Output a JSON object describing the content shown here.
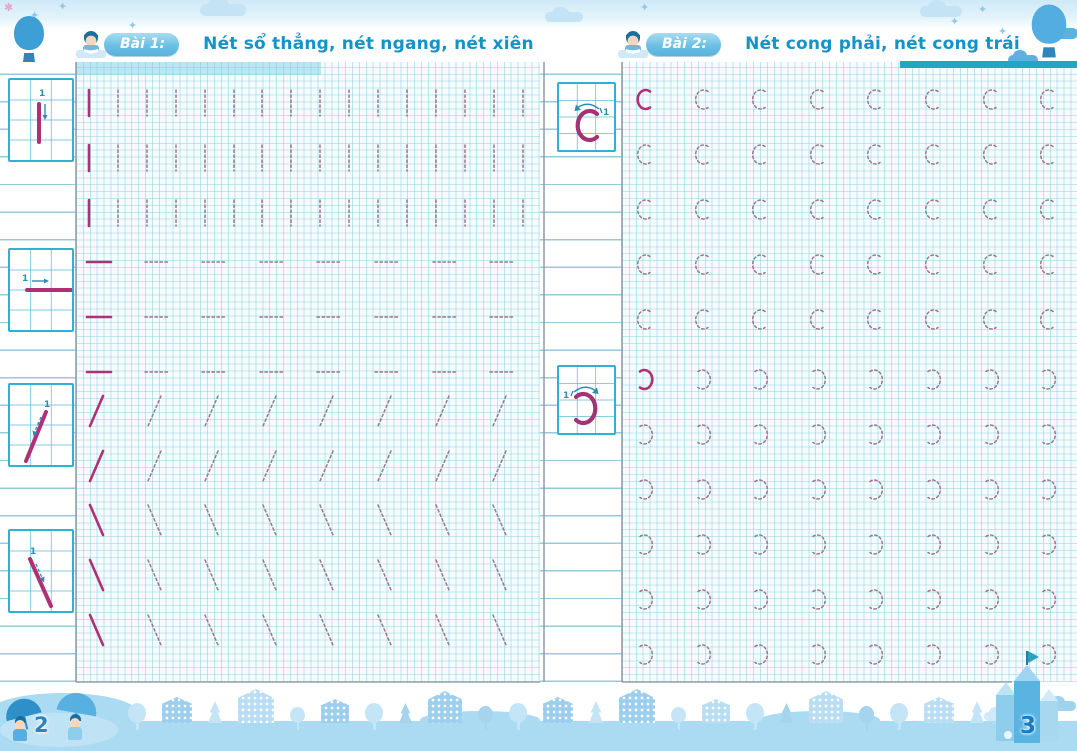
{
  "icons": {
    "star": "✦",
    "sparkle": "✱"
  },
  "colors": {
    "title_blue": "#1593c7",
    "badge_blue": "#6cc0e4",
    "grid_teal": "#2d96b4",
    "stroke_magenta": "#b03078",
    "trace_gray": "#9a7590",
    "footer_blue": "#abdbf2"
  },
  "pages": {
    "left": {
      "lesson_label": "Bài 1:",
      "title": "Nét sổ thẳng, nét ngang, nét xiên",
      "page_number": "2",
      "examples": [
        {
          "name": "vertical-stroke",
          "step_number": "1"
        },
        {
          "name": "horizontal-stroke",
          "step_number": "1"
        },
        {
          "name": "right-slant-stroke",
          "step_number": "1"
        },
        {
          "name": "left-slant-stroke",
          "step_number": "1"
        }
      ],
      "practice_rows": [
        {
          "glyph": "vertical-bar",
          "count": 16,
          "first_solid": true
        },
        {
          "glyph": "vertical-bar",
          "count": 16,
          "first_solid": true
        },
        {
          "glyph": "vertical-bar",
          "count": 16,
          "first_solid": true
        },
        {
          "glyph": "horizontal-bar",
          "count": 8,
          "first_solid": true
        },
        {
          "glyph": "horizontal-bar",
          "count": 8,
          "first_solid": true
        },
        {
          "glyph": "horizontal-bar",
          "count": 8,
          "first_solid": true
        },
        {
          "glyph": "slash",
          "count": 8,
          "first_solid": true
        },
        {
          "glyph": "slash",
          "count": 8,
          "first_solid": true
        },
        {
          "glyph": "backslash",
          "count": 8,
          "first_solid": true
        },
        {
          "glyph": "backslash",
          "count": 8,
          "first_solid": true
        },
        {
          "glyph": "backslash",
          "count": 8,
          "first_solid": true
        }
      ]
    },
    "right": {
      "lesson_label": "Bài 2:",
      "title": "Nét cong phải, nét cong trái",
      "page_number": "3",
      "examples": [
        {
          "name": "right-curve",
          "step_number": "1"
        },
        {
          "name": "left-curve",
          "step_number": "1"
        }
      ],
      "practice_rows": [
        {
          "glyph": "c-curve",
          "count": 8,
          "first_solid": true
        },
        {
          "glyph": "c-curve",
          "count": 8,
          "first_solid": false
        },
        {
          "glyph": "c-curve",
          "count": 8,
          "first_solid": false
        },
        {
          "glyph": "c-curve",
          "count": 8,
          "first_solid": false
        },
        {
          "glyph": "c-curve",
          "count": 8,
          "first_solid": false
        },
        {
          "glyph": "open-c-curve",
          "count": 8,
          "first_solid": true
        },
        {
          "glyph": "open-c-curve",
          "count": 8,
          "first_solid": false
        },
        {
          "glyph": "open-c-curve",
          "count": 8,
          "first_solid": false
        },
        {
          "glyph": "open-c-curve",
          "count": 8,
          "first_solid": false
        },
        {
          "glyph": "open-c-curve",
          "count": 8,
          "first_solid": false
        },
        {
          "glyph": "open-c-curve",
          "count": 8,
          "first_solid": false
        }
      ]
    }
  }
}
